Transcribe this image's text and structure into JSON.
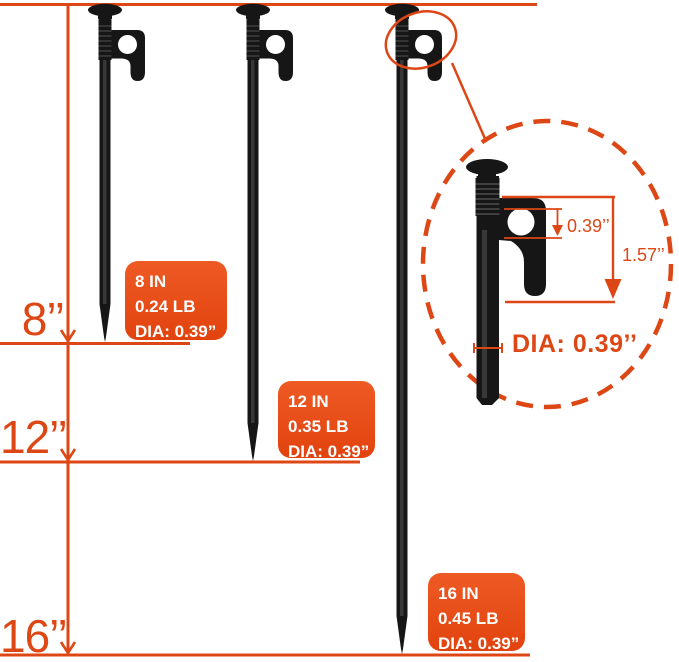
{
  "colors": {
    "accent": "#DC4715",
    "card_bg_top": "#EE5A24",
    "card_bg_bottom": "#E2430E",
    "card_text": "#FFFFFF",
    "stake_color": "#161616"
  },
  "ruler": {
    "marks": [
      {
        "label": "8’’"
      },
      {
        "label": "12’’"
      },
      {
        "label": "16’’"
      }
    ]
  },
  "spec_cards": [
    {
      "size": "8 IN",
      "weight": "0.24 LB",
      "diameter": "DIA: 0.39”"
    },
    {
      "size": "12 IN",
      "weight": "0.35 LB",
      "diameter": "DIA: 0.39”"
    },
    {
      "size": "16 IN",
      "weight": "0.45 LB",
      "diameter": "DIA: 0.39”"
    }
  ],
  "detail": {
    "hole_dimension": "0.39’’",
    "head_height": "1.57’’",
    "diameter_label": "DIA: 0.39’’"
  }
}
